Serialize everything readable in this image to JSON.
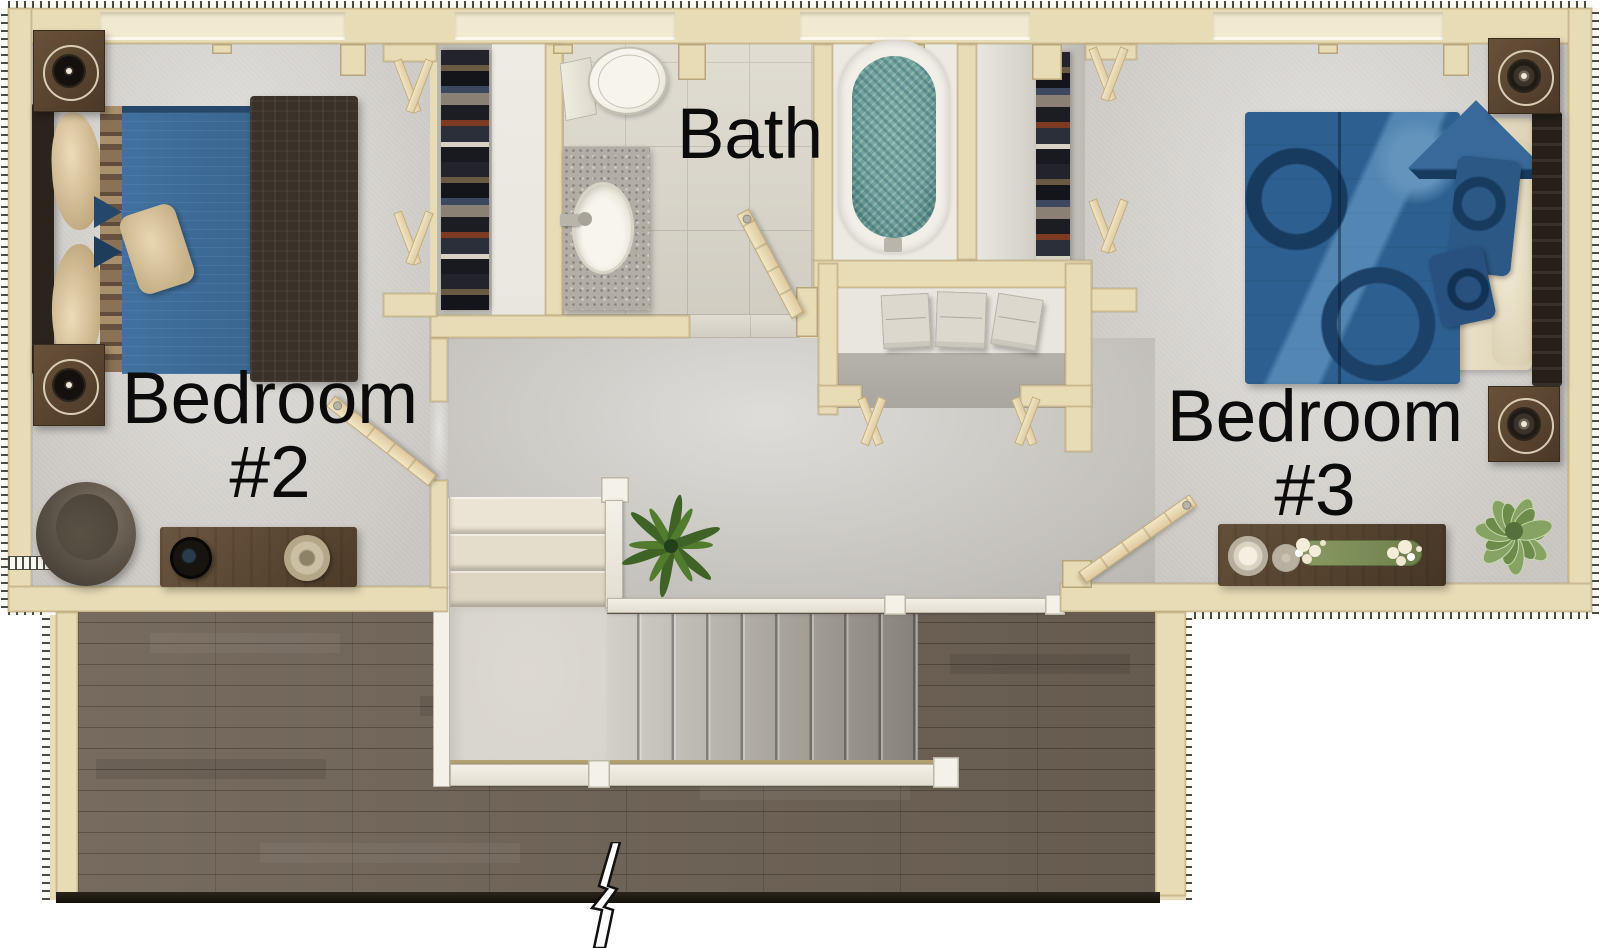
{
  "plan": {
    "title": "Second floor plan",
    "labels": {
      "bedroom2_l1": "Bedroom",
      "bedroom2_l2": "#2",
      "bath": "Bath",
      "bedroom3_l1": "Bedroom",
      "bedroom3_l2": "#3"
    },
    "rooms": [
      {
        "id": "bedroom-2",
        "name": "Bedroom #2",
        "fixtures": [
          "double-bed",
          "dark-headboard",
          "cream-pillows",
          "plaid-blanket",
          "brown-blanket",
          "throw-pillow",
          "speaker-nightstand",
          "speaker-nightstand",
          "round-chair",
          "console-dresser",
          "decor-bowl",
          "candle-lamp",
          "walk-in-closet",
          "hanging-clothes",
          "bifold-closet-doors",
          "swing-door"
        ]
      },
      {
        "id": "bath",
        "name": "Bath",
        "fixtures": [
          "toilet",
          "granite-vanity",
          "oval-sink",
          "bathtub-with-water",
          "swing-door",
          "tile-floor"
        ]
      },
      {
        "id": "bedroom-3",
        "name": "Bedroom #3",
        "fixtures": [
          "double-bed",
          "dark-headboard",
          "patterned-duvet",
          "pillows",
          "speaker-nightstand",
          "speaker-nightstand",
          "dresser",
          "glass-candles",
          "flower-runner",
          "potted-plant",
          "walk-in-closet",
          "hanging-clothes",
          "bifold-closet-doors",
          "swing-door"
        ]
      },
      {
        "id": "hallway",
        "name": "Hallway",
        "fixtures": [
          "staircase-upper-flight",
          "stair-landing",
          "staircase-main-flight",
          "stair-railings",
          "potted-palm",
          "linen-closet",
          "towel-stacks",
          "bifold-closet-doors"
        ]
      },
      {
        "id": "open-area",
        "name": "Open wood-floor area",
        "fixtures": [
          "hardwood-floor",
          "break-line-symbol"
        ]
      }
    ],
    "colors": {
      "wall": "#e8dcb7",
      "wall-light": "#f2ead0",
      "wall-edge": "#c8b78c",
      "carpet": "#d8d5d0",
      "carpet-dark": "#c9c6c0",
      "closet-floor": "#c9c6c1",
      "closet-shelf": "#e9e6df",
      "tile": "#dcd8cc",
      "grout": "#c4bfb2",
      "alcove": "#edeae2",
      "wood": "#6f6356",
      "wood-line": "#4e443a",
      "stair-light": "#d3d0c8",
      "stair-dark": "#87837b",
      "upper-stair": "#e8e1d1",
      "landing": "#d7d4cc",
      "rail": "#f4f1e9",
      "rail-edge": "#bcb6a6",
      "gold": "#b3a171",
      "water": "#6fa2a0",
      "water-dark": "#3f7471",
      "tub-rim": "#f1efe7",
      "porcelain": "#f2f0e8",
      "granite": "#b2aea6",
      "bed2-blue": "#41719e",
      "bed2-navy": "#25476a",
      "blanket": "#3a3129",
      "plaid-a": "#8a7257",
      "plaid-b": "#675240",
      "plaid-c": "#a8906c",
      "pillow": "#e0cfa8",
      "bed3-blue": "#2d6090",
      "bed3-navy": "#173a5f",
      "bed3-light": "#6494bc",
      "sheet": "#ece3cb",
      "nightstand": "#5a452f",
      "dresser": "#5a4733",
      "plant": "#3f6326",
      "plant-light": "#86a363",
      "chair": "#5d5448",
      "ink": "#0b0b0b",
      "towel": "#dcd8ce"
    }
  }
}
